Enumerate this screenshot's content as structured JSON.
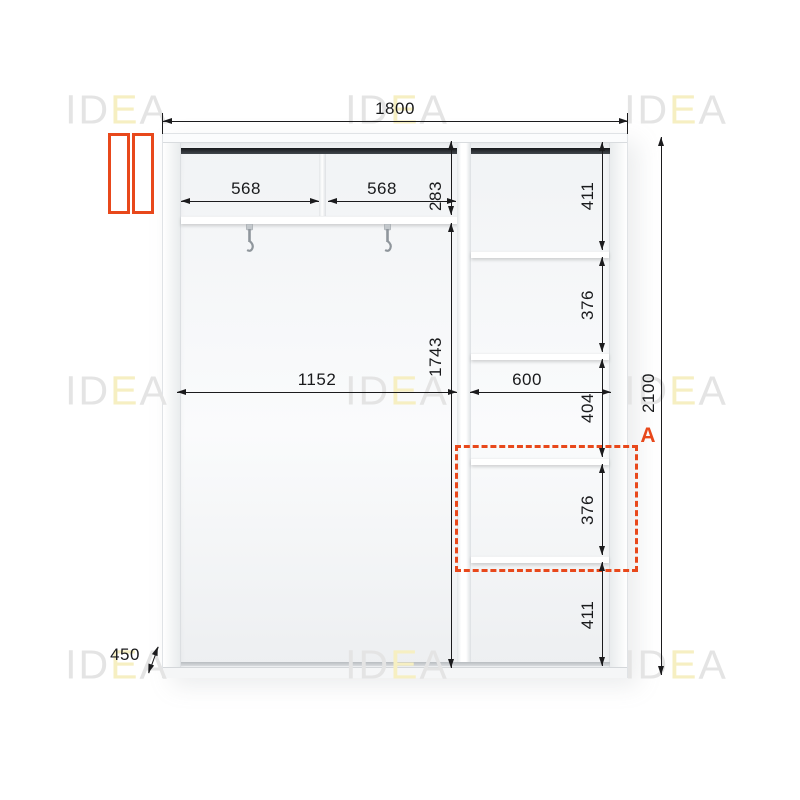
{
  "watermark": {
    "part_gray_1": "ID",
    "part_yellow": "E",
    "part_gray_2": "A"
  },
  "schematic": {
    "section_label": "A",
    "dimensions": {
      "overall_width_mm": "1800",
      "overall_height_mm": "2100",
      "depth_mm": "450",
      "top_compartment_width_1": "568",
      "top_compartment_width_2": "568",
      "top_section_height": "283",
      "hanging_section_width": "1152",
      "hanging_section_height": "1743",
      "shelf_column_width": "600",
      "shelf_column_heights": [
        "411",
        "376",
        "404",
        "376",
        "411"
      ]
    },
    "icons": {
      "door_icon": "sliding-doors-icon",
      "hook_icon": "coat-hook-icon"
    },
    "colors": {
      "accent_orange": "#e8481b",
      "dimension_ink": "#1b1b1d",
      "watermark_gray": "#e4e4e4",
      "watermark_yellow": "#f6efc2"
    }
  }
}
